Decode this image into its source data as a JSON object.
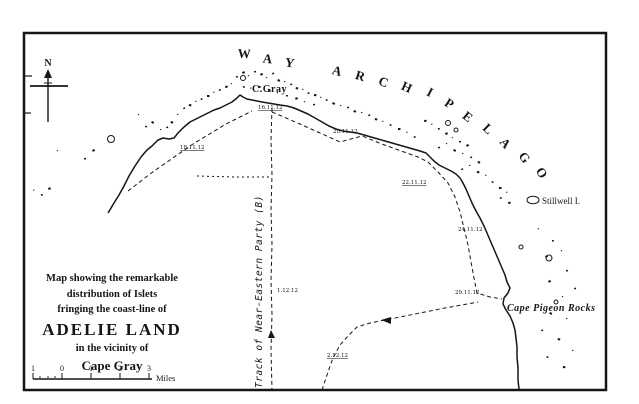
{
  "page": {
    "bg": "#ffffff",
    "ink": "#161616"
  },
  "map": {
    "north_label": "N",
    "arc_title": {
      "text": "WAY ARCHIPELAGO",
      "letters": [
        {
          "ch": "W",
          "x": 244,
          "y": 58,
          "r": 3
        },
        {
          "ch": "A",
          "x": 267,
          "y": 63,
          "r": 6
        },
        {
          "ch": "Y",
          "x": 289,
          "y": 67,
          "r": 9
        },
        {
          "ch": "A",
          "x": 336,
          "y": 75,
          "r": 14
        },
        {
          "ch": "R",
          "x": 359,
          "y": 80,
          "r": 17
        },
        {
          "ch": "C",
          "x": 382,
          "y": 86,
          "r": 20
        },
        {
          "ch": "H",
          "x": 405,
          "y": 91,
          "r": 24
        },
        {
          "ch": "I",
          "x": 428,
          "y": 96,
          "r": 28
        },
        {
          "ch": "P",
          "x": 447,
          "y": 107,
          "r": 33
        },
        {
          "ch": "E",
          "x": 465,
          "y": 120,
          "r": 38
        },
        {
          "ch": "L",
          "x": 485,
          "y": 132,
          "r": 43
        },
        {
          "ch": "A",
          "x": 502,
          "y": 146,
          "r": 48
        },
        {
          "ch": "G",
          "x": 521,
          "y": 160,
          "r": 53
        },
        {
          "ch": "O",
          "x": 538,
          "y": 175,
          "r": 58
        }
      ]
    },
    "labels": {
      "cape_gray": "C.Gray",
      "stillwell": "Stillwell I.",
      "cape_pigeon": "Cape Pigeon Rocks",
      "track": "Track of Near-Eastern Party (B)"
    },
    "date_labels": [
      {
        "t": "18.11.12",
        "x": 180,
        "y": 149,
        "u": 1
      },
      {
        "t": "16.11.12",
        "x": 258,
        "y": 109,
        "u": 1
      },
      {
        "t": "20.11.12",
        "x": 333,
        "y": 133,
        "u": 0
      },
      {
        "t": "22.11.12",
        "x": 402,
        "y": 184,
        "u": 1
      },
      {
        "t": "24.11.12",
        "x": 458,
        "y": 231,
        "u": 0
      },
      {
        "t": "29.11.12",
        "x": 455,
        "y": 294,
        "u": 0
      },
      {
        "t": "1.12.12",
        "x": 277,
        "y": 292,
        "u": 0
      },
      {
        "t": "2.12.12",
        "x": 327,
        "y": 357,
        "u": 1
      }
    ],
    "title_block": {
      "lines": [
        "Map showing the remarkable",
        "distribution of Islets",
        "fringing the coast-line of",
        "ADELIE LAND",
        "in the vicinity of",
        "Cape Gray"
      ]
    },
    "scale": {
      "labels": [
        {
          "t": "1",
          "x": 33
        },
        {
          "t": "0",
          "x": 62
        },
        {
          "t": "1",
          "x": 91
        },
        {
          "t": "2",
          "x": 120
        },
        {
          "t": "3",
          "x": 149
        }
      ],
      "unit": "Miles",
      "subdots": [
        40,
        48,
        55
      ]
    },
    "islets": {
      "specks": [
        [
          33,
          190
        ],
        [
          41,
          194
        ],
        [
          48,
          188
        ],
        [
          57,
          150
        ],
        [
          84,
          158
        ],
        [
          92,
          150
        ],
        [
          138,
          114
        ],
        [
          145,
          126
        ],
        [
          152,
          121
        ],
        [
          160,
          129
        ],
        [
          166,
          127
        ],
        [
          171,
          121
        ],
        [
          177,
          114
        ],
        [
          183,
          108
        ],
        [
          189,
          104
        ],
        [
          195,
          101
        ],
        [
          201,
          98
        ],
        [
          207,
          95
        ],
        [
          213,
          92
        ],
        [
          219,
          89
        ],
        [
          225,
          86
        ],
        [
          231,
          83
        ],
        [
          236,
          76
        ],
        [
          242,
          72
        ],
        [
          248,
          75
        ],
        [
          254,
          71
        ],
        [
          260,
          74
        ],
        [
          266,
          77
        ],
        [
          272,
          73
        ],
        [
          278,
          79
        ],
        [
          284,
          81
        ],
        [
          290,
          84
        ],
        [
          296,
          87
        ],
        [
          302,
          89
        ],
        [
          308,
          92
        ],
        [
          314,
          94
        ],
        [
          320,
          97
        ],
        [
          326,
          99
        ],
        [
          258,
          86
        ],
        [
          250,
          88
        ],
        [
          243,
          86
        ],
        [
          268,
          90
        ],
        [
          277,
          92
        ],
        [
          286,
          95
        ],
        [
          295,
          98
        ],
        [
          304,
          101
        ],
        [
          313,
          104
        ],
        [
          333,
          102
        ],
        [
          340,
          105
        ],
        [
          347,
          107
        ],
        [
          354,
          110
        ],
        [
          361,
          112
        ],
        [
          368,
          115
        ],
        [
          375,
          118
        ],
        [
          382,
          121
        ],
        [
          390,
          124
        ],
        [
          398,
          128
        ],
        [
          406,
          132
        ],
        [
          414,
          136
        ],
        [
          424,
          120
        ],
        [
          431,
          124
        ],
        [
          438,
          128
        ],
        [
          445,
          133
        ],
        [
          452,
          137
        ],
        [
          459,
          141
        ],
        [
          466,
          145
        ],
        [
          446,
          143
        ],
        [
          438,
          147
        ],
        [
          454,
          149
        ],
        [
          462,
          153
        ],
        [
          470,
          157
        ],
        [
          478,
          161
        ],
        [
          469,
          165
        ],
        [
          461,
          169
        ],
        [
          477,
          171
        ],
        [
          485,
          175
        ],
        [
          492,
          181
        ],
        [
          499,
          187
        ],
        [
          506,
          192
        ],
        [
          500,
          197
        ],
        [
          508,
          202
        ],
        [
          538,
          228
        ],
        [
          552,
          240
        ],
        [
          545,
          256
        ],
        [
          561,
          250
        ],
        [
          566,
          270
        ],
        [
          548,
          281
        ],
        [
          562,
          296
        ],
        [
          574,
          288
        ],
        [
          550,
          312
        ],
        [
          566,
          318
        ],
        [
          541,
          330
        ],
        [
          558,
          338
        ],
        [
          572,
          350
        ],
        [
          547,
          356
        ],
        [
          563,
          366
        ]
      ],
      "circles": [
        [
          111,
          139,
          3.5
        ],
        [
          243,
          78,
          2.5
        ],
        [
          448,
          123,
          2.5
        ],
        [
          456,
          130,
          2
        ],
        [
          549,
          258,
          3
        ],
        [
          521,
          247,
          2
        ],
        [
          556,
          302,
          2
        ]
      ]
    }
  }
}
